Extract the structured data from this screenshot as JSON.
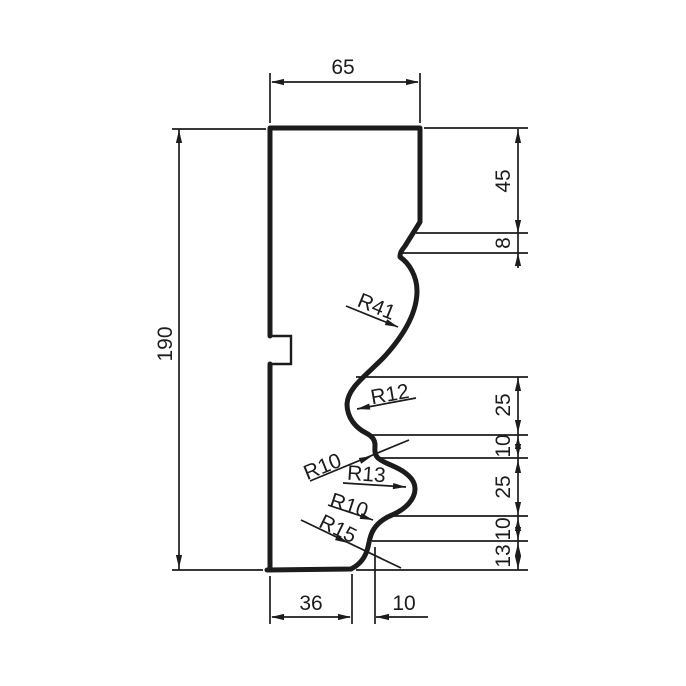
{
  "drawing": {
    "type": "technical-profile-drawing",
    "description": "Dimensioned cross-section profile of a moulding",
    "colors": {
      "line": "#1c1c1c",
      "background": "#ffffff"
    },
    "dims": {
      "top_width": "65",
      "left_height": "190",
      "right_45": "45",
      "right_8": "8",
      "right_25a": "25",
      "right_10a": "10",
      "right_25b": "25",
      "right_10b": "10",
      "right_13": "13",
      "bottom_36": "36",
      "bottom_10": "10"
    },
    "radii": {
      "r41": "R41",
      "r12": "R12",
      "r10a": "R10",
      "r13": "R13",
      "r10b": "R10",
      "r15": "R15"
    }
  }
}
